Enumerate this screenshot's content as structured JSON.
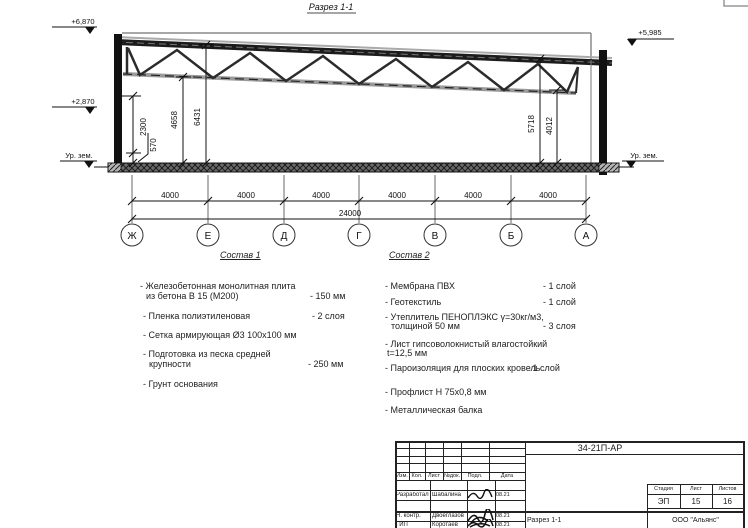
{
  "drawing": {
    "section_title": "Разрез 1-1",
    "elev_top_left": "+6,870",
    "elev_mid_left": "+2,870",
    "elev_top_right": "+5,985",
    "ground_label_left": "Ур. зем.",
    "ground_label_right": "Ур. зем.",
    "dim_left_inner": "2300",
    "dim_left_small": "570",
    "dim_left_mid": "4658",
    "dim_left_outer": "6431",
    "dim_right_outer": "5718",
    "dim_right_inner": "4012",
    "bay_dims": [
      "4000",
      "4000",
      "4000",
      "4000",
      "4000",
      "4000"
    ],
    "total_dim": "24000",
    "axes": [
      "Ж",
      "Е",
      "Д",
      "Г",
      "В",
      "Б",
      "А"
    ]
  },
  "sostav1": {
    "heading": "Состав 1",
    "items": [
      {
        "text": "- Железобетонная  монолитная плита",
        "text2": "из бетона В 15 (М200)",
        "value": "- 150 мм"
      },
      {
        "text": "- Пленка полиэтиленовая",
        "value": "- 2 слоя"
      },
      {
        "text": "- Сетка армирующая Ø3 100х100 мм"
      },
      {
        "text": "- Подготовка из песка средней",
        "text2": "крупности",
        "value": "- 250 мм"
      },
      {
        "text": "- Грунт основания"
      }
    ]
  },
  "sostav2": {
    "heading": "Состав 2",
    "items": [
      {
        "text": "- Мембрана ПВХ",
        "value": "- 1 слой"
      },
      {
        "text": "- Геотекстиль",
        "value": "- 1 слой"
      },
      {
        "text": "- Утеплитель ПЕНОПЛЭКС γ=30кг/м3,",
        "text2": "толщиной 50 мм",
        "value": "- 3 слоя"
      },
      {
        "text": "- Лист гипсоволокнистый влагостойкий",
        "text2": "t=12,5 мм"
      },
      {
        "text": "- Пароизоляция для плоских кровель",
        "value": "- 1 слой"
      },
      {
        "text": "- Профлист Н 75х0,8 мм"
      },
      {
        "text": "- Металлическая балка"
      }
    ]
  },
  "stamp": {
    "doc_number": "34-21П-АР",
    "change_headers": [
      "Изм.",
      "Кол.",
      "Лист",
      "№док.",
      "Подл.",
      "Дата"
    ],
    "rows": [
      {
        "role": "Разработал",
        "name": "Шабалина",
        "date": "08.21"
      },
      {
        "role": "Н. контр.",
        "name": "Двоеглазов",
        "date": "08.21"
      },
      {
        "role": "ГИП",
        "name": "Коротаев",
        "date": "08.21"
      }
    ],
    "stage_header": "Стадия",
    "sheet_header": "Лист",
    "sheets_header": "Листов",
    "stage": "ЭП",
    "sheet": "15",
    "sheets": "16",
    "drawing_title": "Разрез 1-1",
    "organization": "ООО \"Альянс\""
  }
}
